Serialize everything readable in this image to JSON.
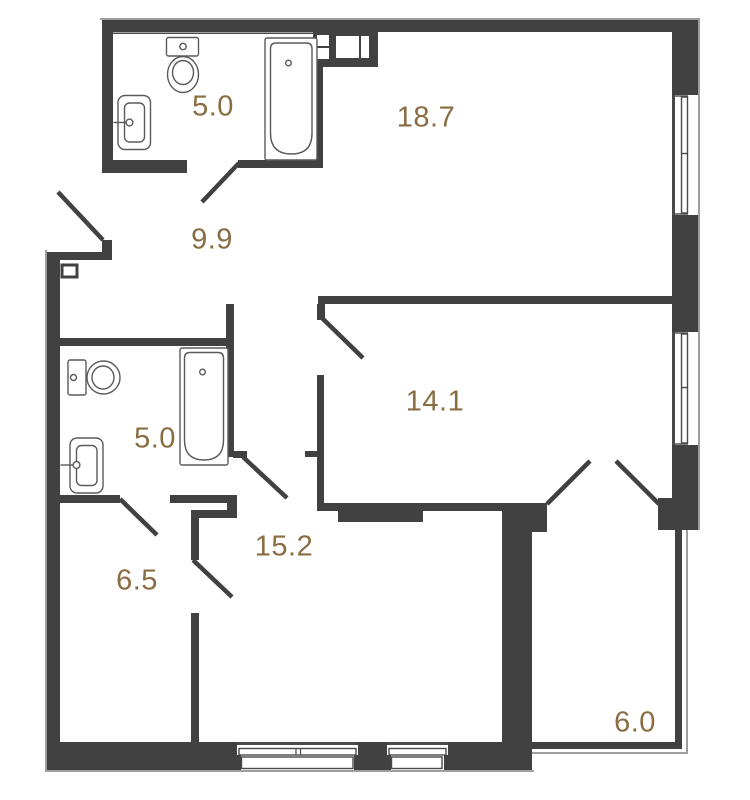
{
  "floorplan": {
    "rooms": [
      {
        "id": "bathroom-top",
        "area": "5.0"
      },
      {
        "id": "living-room",
        "area": "18.7"
      },
      {
        "id": "hallway",
        "area": "9.9"
      },
      {
        "id": "bathroom-middle",
        "area": "5.0"
      },
      {
        "id": "bedroom",
        "area": "14.1"
      },
      {
        "id": "kitchen-living",
        "area": "15.2"
      },
      {
        "id": "corridor",
        "area": "6.5"
      },
      {
        "id": "balcony",
        "area": "6.0"
      }
    ],
    "colors": {
      "wall": "#414141",
      "label": "#8a6c42",
      "fixture_line": "#5a5a5a",
      "window_line": "#4a4a4a",
      "outer_hairline": "#9e9e9e",
      "background": "#ffffff"
    }
  }
}
